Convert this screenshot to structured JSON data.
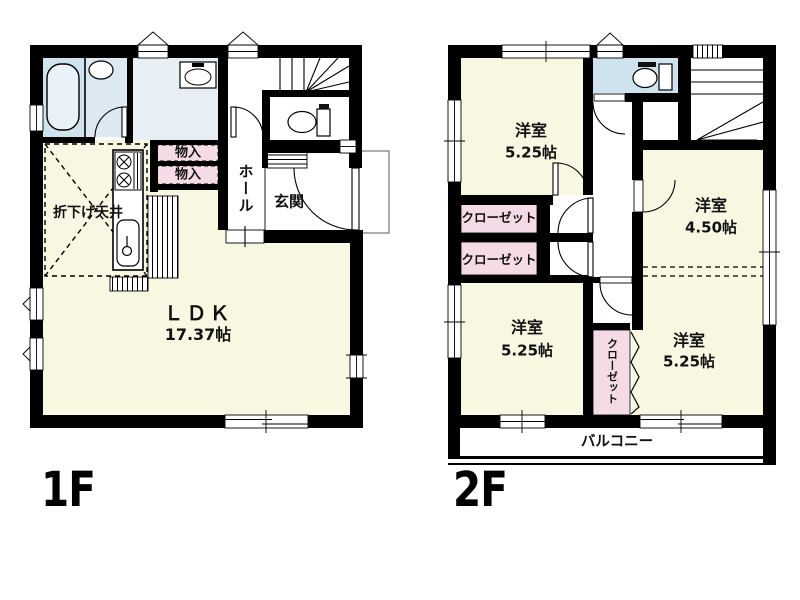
{
  "floor1": {
    "floor_label": "1F",
    "ldk": {
      "name": "ＬＤＫ",
      "size": "17.37帖"
    },
    "lowered_ceiling": "折下げ天井",
    "storage_upper": "物入",
    "storage_lower": "物入",
    "hall": "ホール",
    "entrance": "玄関"
  },
  "floor2": {
    "floor_label": "2F",
    "bedroom_nw": {
      "name": "洋室",
      "size": "5.25帖"
    },
    "bedroom_e": {
      "name": "洋室",
      "size": "4.50帖"
    },
    "bedroom_sw": {
      "name": "洋室",
      "size": "5.25帖"
    },
    "bedroom_se": {
      "name": "洋室",
      "size": "5.25帖"
    },
    "closet_a": "クローゼット",
    "closet_b": "クローゼット",
    "closet_c": "クローゼット",
    "balcony": "バルコニー"
  },
  "colors": {
    "wall": "#000000",
    "room_yellow": "#f8f7e2",
    "wet_blue": "#cfe3ee",
    "wet_blue_light": "#e7eef4",
    "closet_pink": "#f5dbe6"
  },
  "fixtures": [
    "bathtub",
    "washing-machine",
    "vanity-basin",
    "toilet",
    "kitchen-stove",
    "kitchen-sink",
    "staircase",
    "balcony-rail"
  ]
}
